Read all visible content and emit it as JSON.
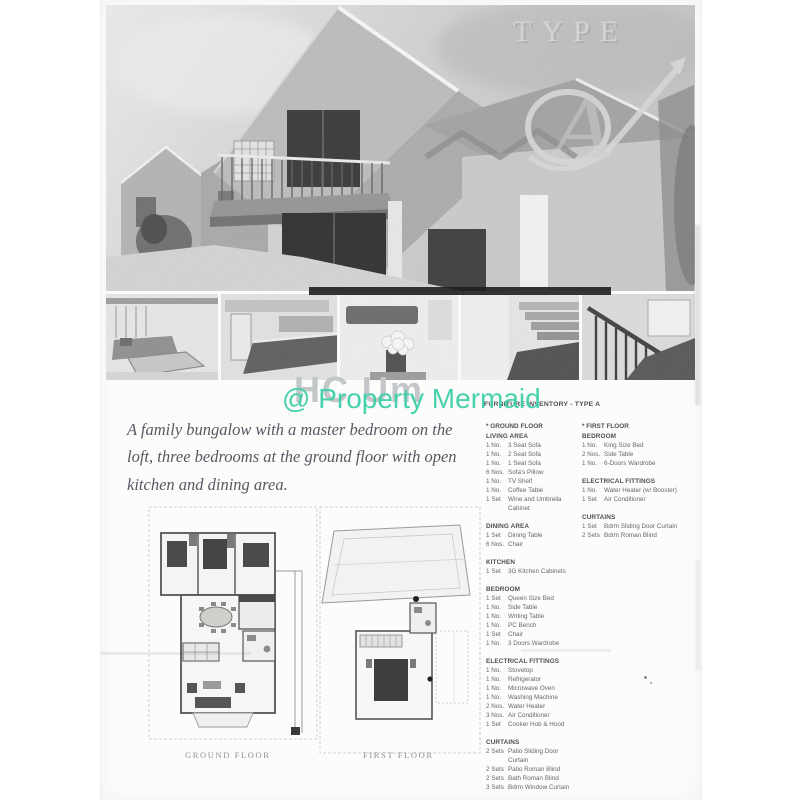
{
  "hero": {
    "type_word": "TYPE",
    "type_letter": "A"
  },
  "watermarks": {
    "scan_text": "HC Um",
    "overlay_text": "@ Property Mermaid",
    "overlay_color": "#3ecfa9"
  },
  "description": "A family bungalow with a master bedroom on the loft, three bedrooms at the ground floor with open kitchen and dining area.",
  "plans": {
    "ground_label": "GROUND FLOOR",
    "first_label": "FIRST FLOOR"
  },
  "inventory": {
    "title": "FURNITURE INVENTORY - TYPE A",
    "columns": [
      {
        "header": "* GROUND FLOOR",
        "sections": [
          {
            "name": "LIVING AREA",
            "items": [
              {
                "qty": "1 No.",
                "label": "3 Seat Sofa"
              },
              {
                "qty": "1 No.",
                "label": "2 Seat Sofa"
              },
              {
                "qty": "1 No.",
                "label": "1 Seat Sofa"
              },
              {
                "qty": "6 Nos.",
                "label": "Sofa's Pillow"
              },
              {
                "qty": "1 No.",
                "label": "TV Shelf"
              },
              {
                "qty": "1 No.",
                "label": "Coffee Table"
              },
              {
                "qty": "1 Set",
                "label": "Wine and Umbrella Cabinet"
              }
            ]
          },
          {
            "name": "DINING AREA",
            "items": [
              {
                "qty": "1 Set",
                "label": "Dining Table"
              },
              {
                "qty": "6 Nos.",
                "label": "Chair"
              }
            ]
          },
          {
            "name": "KITCHEN",
            "items": [
              {
                "qty": "1 Set",
                "label": "3G Kitchen Cabinets"
              }
            ]
          },
          {
            "name": "BEDROOM",
            "items": [
              {
                "qty": "1 Set",
                "label": "Queen Size Bed"
              },
              {
                "qty": "1 No.",
                "label": "Side Table"
              },
              {
                "qty": "1 No.",
                "label": "Writing Table"
              },
              {
                "qty": "1 No.",
                "label": "PC Bench"
              },
              {
                "qty": "1 Set",
                "label": "Chair"
              },
              {
                "qty": "1 No.",
                "label": "3 Doors Wardrobe"
              }
            ]
          },
          {
            "name": "ELECTRICAL FITTINGS",
            "items": [
              {
                "qty": "1 No.",
                "label": "Stovetop"
              },
              {
                "qty": "1 No.",
                "label": "Refrigerator"
              },
              {
                "qty": "1 No.",
                "label": "Microwave Oven"
              },
              {
                "qty": "1 No.",
                "label": "Washing Machine"
              },
              {
                "qty": "2 Nos.",
                "label": "Water Heater"
              },
              {
                "qty": "3 Nos.",
                "label": "Air Conditioner"
              },
              {
                "qty": "1 Set",
                "label": "Cooker Hob & Hood"
              }
            ]
          },
          {
            "name": "CURTAINS",
            "items": [
              {
                "qty": "2 Sets",
                "label": "Patio Sliding Door Curtain"
              },
              {
                "qty": "2 Sets",
                "label": "Patio Roman Blind"
              },
              {
                "qty": "2 Sets",
                "label": "Bath Roman Blind"
              },
              {
                "qty": "3 Sets",
                "label": "Bdrm Window Curtain"
              }
            ]
          }
        ]
      },
      {
        "header": "* FIRST FLOOR",
        "sections": [
          {
            "name": "BEDROOM",
            "items": [
              {
                "qty": "1 No.",
                "label": "King Size Bed"
              },
              {
                "qty": "2 Nos.",
                "label": "Side Table"
              },
              {
                "qty": "1 No.",
                "label": "6-Doors Wardrobe"
              }
            ]
          },
          {
            "name": "ELECTRICAL FITTINGS",
            "items": [
              {
                "qty": "1 No.",
                "label": "Water Heater (w/ Booster)"
              },
              {
                "qty": "1 Set",
                "label": "Air Conditioner"
              }
            ]
          },
          {
            "name": "CURTAINS",
            "items": [
              {
                "qty": "1 Set",
                "label": "Bdrm Sliding Door Curtain"
              },
              {
                "qty": "2 Sets",
                "label": "Bdrm Roman Blind"
              }
            ]
          }
        ]
      }
    ]
  }
}
